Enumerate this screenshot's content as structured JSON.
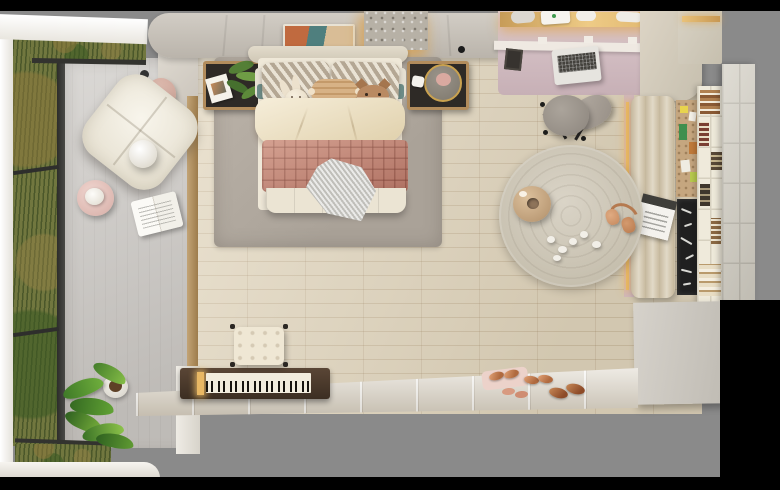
{
  "scene": {
    "description": "Top-down 3D render of a kids bedroom: balcony reading nook with window greenery on the left, double bed with terracotta quilt in the center, desk zone and tufted bench with shelving on the right, round rug, piano and bench at the bottom",
    "view": "top-down",
    "presentation": "render letterboxed on gray canvas with black bars"
  },
  "palette": {
    "canvas_gray": "#8a8a8a",
    "letterbox_black": "#000000",
    "wood_floor": "#e2d6bd",
    "nook_floor_gray": "#cfccc8",
    "area_rug_gray": "#b4aca2",
    "round_rug_beige": "#cdc6b7",
    "wall_beige": "#c8c2b9",
    "duvet_cream": "#efe6cf",
    "quilt_terracotta": "#c28171",
    "desk_mauve": "#d2bcc2",
    "bench_tufted_beige": "#d5c9af",
    "greenery_green": "#71773f",
    "led_amber": "#e8b763",
    "chalkboard_black": "#202020",
    "lounge_chair_white": "#f3efe5",
    "slipper_copper": "#c97d4e"
  },
  "objects": {
    "area_rug": {
      "label": "Gray area rug under the bed"
    },
    "bed": {
      "label": "Double bed with cream duvet and terracotta quilted blanket"
    },
    "pillows": {
      "label": "Chevron patterned pillows with woven lumbar cushion"
    },
    "plush_bunny": {
      "label": "Plush bunny toy on bed"
    },
    "plush_fox": {
      "label": "Plush fox toy on bed"
    },
    "knit_throw": {
      "label": "Gray knit throw on quilt"
    },
    "nightstand_left": {
      "label": "Left nightstand with plant and art print"
    },
    "nightstand_right": {
      "label": "Right nightstand with round mirror tray"
    },
    "wall_art": {
      "label": "Framed abstract artwork above headboard"
    },
    "textured_panel": {
      "label": "Backlit textured wall panel"
    },
    "window_left": {
      "label": "Floor-to-ceiling window with greenery outside"
    },
    "lounge_chair": {
      "label": "White tufted lounge chair in window nook"
    },
    "pendant_lamp": {
      "label": "Pendant lamp hanging over lounge chair"
    },
    "side_table": {
      "label": "Blush round side table with teapot"
    },
    "open_magazine": {
      "label": "Open magazine on nook floor"
    },
    "floor_plant": {
      "label": "Potted green plant in nook corner"
    },
    "desk": {
      "label": "Desk zone with laptop and LED-lit shelf"
    },
    "laptop": {
      "label": "Open laptop on desk"
    },
    "desk_chair": {
      "label": "Gray swivel desk chair"
    },
    "round_rug": {
      "label": "Round textured beige rug"
    },
    "donut_pouf": {
      "label": "Donut-shaped floor pouf"
    },
    "small_toys": {
      "label": "Small white toys scattered on round rug"
    },
    "headphones": {
      "label": "Rose-gold headphones at rug edge"
    },
    "daybed_bench": {
      "label": "Long tufted window bench"
    },
    "bench_magazine": {
      "label": "Magazine lying on bench"
    },
    "cork_board": {
      "label": "Cork pin board with notes"
    },
    "chalkboard": {
      "label": "Chalkboard panel with chalk writing"
    },
    "cube_shelf": {
      "label": "Cube bookshelf with book stacks"
    },
    "wardrobe": {
      "label": "Wardrobe cabinet seen from the top"
    },
    "piano": {
      "label": "Upright piano with exposed keyboard"
    },
    "piano_bench": {
      "label": "Tufted piano bench"
    },
    "slippers": {
      "label": "Copper slippers near bottom wall"
    }
  }
}
